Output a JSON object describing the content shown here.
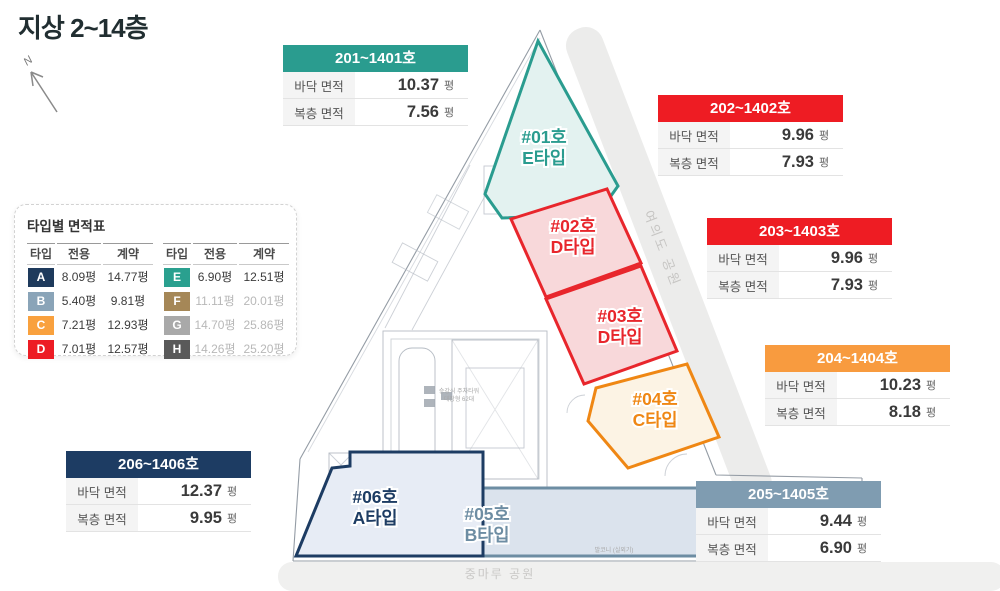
{
  "page_title": "지상 2~14층",
  "compass": {
    "label": "N"
  },
  "area_table": {
    "title": "타입별 면적표",
    "columns": {
      "type": "타입",
      "exclusive": "전용",
      "contract": "계약"
    },
    "left_rows": [
      {
        "type": "A",
        "color": "#1e3a5c",
        "exclusive": "8.09평",
        "contract": "14.77평"
      },
      {
        "type": "B",
        "color": "#8aa4b8",
        "exclusive": "5.40평",
        "contract": "9.81평"
      },
      {
        "type": "C",
        "color": "#f9a13e",
        "exclusive": "7.21평",
        "contract": "12.93평"
      },
      {
        "type": "D",
        "color": "#ed1c24",
        "exclusive": "7.01평",
        "contract": "12.57평"
      }
    ],
    "right_rows": [
      {
        "type": "E",
        "color": "#2aa08f",
        "exclusive": "6.90평",
        "contract": "12.51평"
      },
      {
        "type": "F",
        "color": "#a58757",
        "exclusive": "11.11평",
        "contract": "20.01평"
      },
      {
        "type": "G",
        "color": "#a9a9a9",
        "exclusive": "14.70평",
        "contract": "25.86평"
      },
      {
        "type": "H",
        "color": "#595959",
        "exclusive": "14.26평",
        "contract": "25.20평"
      }
    ]
  },
  "unit_cards": [
    {
      "id": "201~1401호",
      "color": "#2a9c8f",
      "rows": [
        {
          "label": "바닥 면적",
          "value": "10.37",
          "unit": "평"
        },
        {
          "label": "복층 면적",
          "value": "7.56",
          "unit": "평"
        }
      ]
    },
    {
      "id": "202~1402호",
      "color": "#ee1c23",
      "rows": [
        {
          "label": "바닥 면적",
          "value": "9.96",
          "unit": "평"
        },
        {
          "label": "복층 면적",
          "value": "7.93",
          "unit": "평"
        }
      ]
    },
    {
      "id": "203~1403호",
      "color": "#ee1c23",
      "rows": [
        {
          "label": "바닥 면적",
          "value": "9.96",
          "unit": "평"
        },
        {
          "label": "복층 면적",
          "value": "7.93",
          "unit": "평"
        }
      ]
    },
    {
      "id": "204~1404호",
      "color": "#f89b3f",
      "rows": [
        {
          "label": "바닥 면적",
          "value": "10.23",
          "unit": "평"
        },
        {
          "label": "복층 면적",
          "value": "8.18",
          "unit": "평"
        }
      ]
    },
    {
      "id": "205~1405호",
      "color": "#7f9cb1",
      "rows": [
        {
          "label": "바닥 면적",
          "value": "9.44",
          "unit": "평"
        },
        {
          "label": "복층 면적",
          "value": "6.90",
          "unit": "평"
        }
      ]
    },
    {
      "id": "206~1406호",
      "color": "#1d3c63",
      "rows": [
        {
          "label": "바닥 면적",
          "value": "12.37",
          "unit": "평"
        },
        {
          "label": "복층 면적",
          "value": "9.95",
          "unit": "평"
        }
      ]
    }
  ],
  "floorplan": {
    "units": [
      {
        "no": "#01호",
        "type": "E타입",
        "color": "#2a9c8f",
        "fill": "#e3f2f0"
      },
      {
        "no": "#02호",
        "type": "D타입",
        "color": "#e8262c",
        "fill": "#f8d8da"
      },
      {
        "no": "#03호",
        "type": "D타입",
        "color": "#e8262c",
        "fill": "#f8d8da"
      },
      {
        "no": "#04호",
        "type": "C타입",
        "color": "#ef8714",
        "fill": "#fcf3e4"
      },
      {
        "no": "#05호",
        "type": "B타입",
        "color": "#6d8da3",
        "fill": "#dbe3ed"
      },
      {
        "no": "#06호",
        "type": "A타입",
        "color": "#1d3c63",
        "fill": "#e7ecf5"
      }
    ],
    "right_band_label": "여의도 공원",
    "bottom_band_label": "중마루 공원",
    "notes": {
      "parking_line1": "승강식 주차타워",
      "parking_line2": "대장형 62대",
      "balcony": "발코니 (실외기)"
    }
  }
}
